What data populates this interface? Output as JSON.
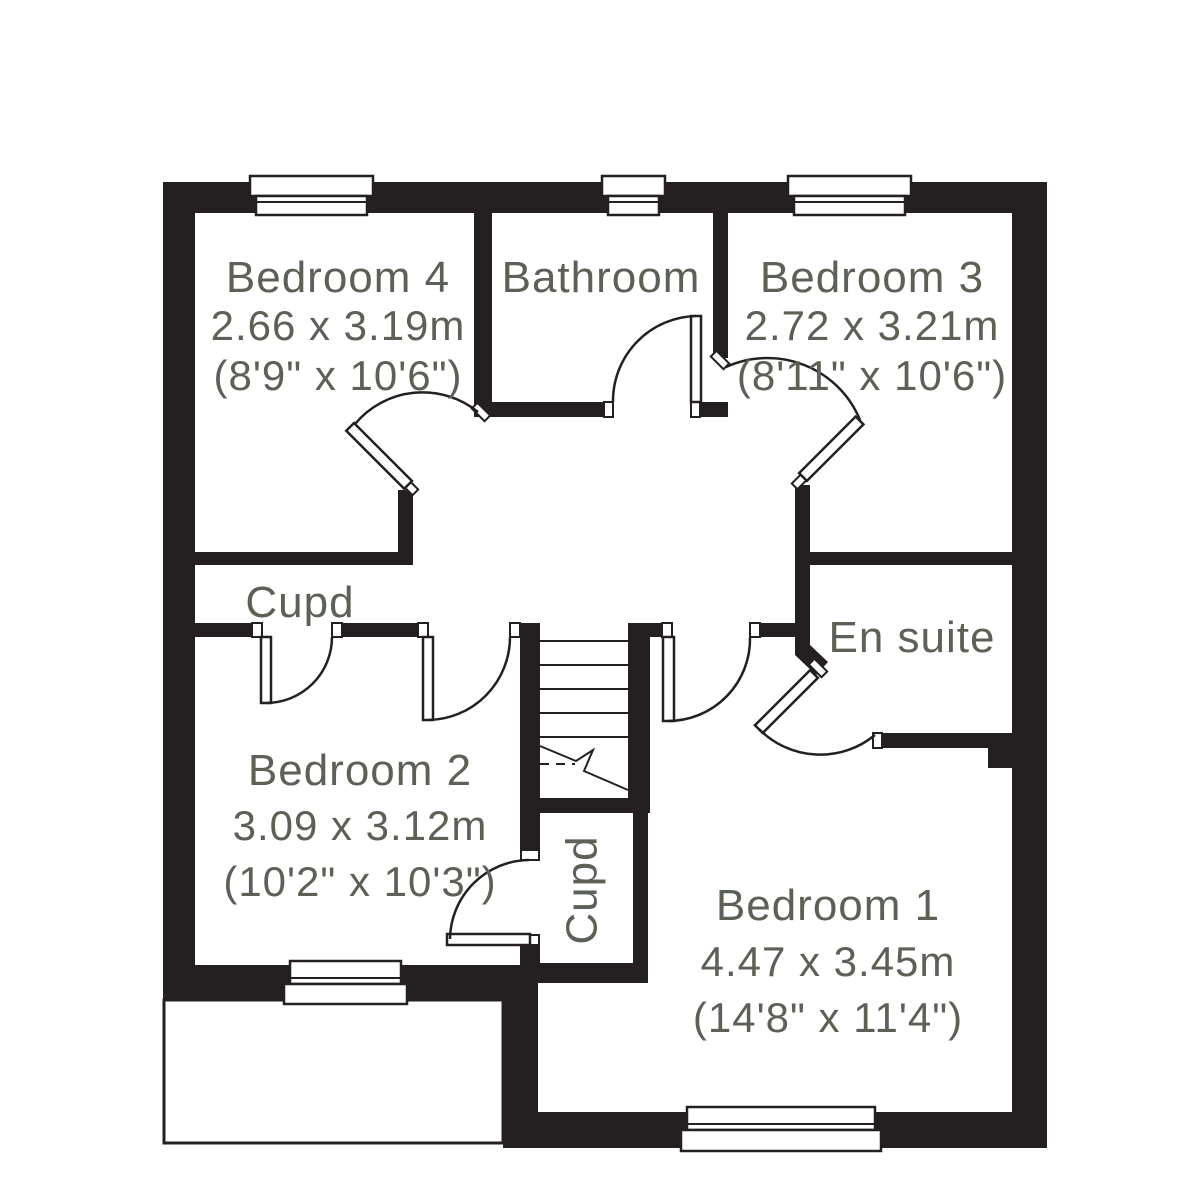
{
  "floorplan": {
    "background_color": "#ffffff",
    "wall_color": "#241f21",
    "label_color": "#5c6157",
    "rooms": [
      {
        "id": "bedroom-4",
        "label": "Bedroom 4",
        "size_metric": "2.66 x 3.19m",
        "size_imperial": "(8'9\" x 10'6\")"
      },
      {
        "id": "bathroom",
        "label": "Bathroom"
      },
      {
        "id": "bedroom-3",
        "label": "Bedroom 3",
        "size_metric": "2.72 x 3.21m",
        "size_imperial": "(8'11\" x 10'6\")"
      },
      {
        "id": "cupboard-landing",
        "label": "Cupd"
      },
      {
        "id": "en-suite",
        "label": "En suite"
      },
      {
        "id": "bedroom-2",
        "label": "Bedroom 2",
        "size_metric": "3.09 x 3.12m",
        "size_imperial": "(10'2\" x 10'3\")"
      },
      {
        "id": "cupboard-understairs",
        "label": "Cupd"
      },
      {
        "id": "bedroom-1",
        "label": "Bedroom 1",
        "size_metric": "4.47 x 3.45m",
        "size_imperial": "(14'8\" x 11'4\")"
      }
    ]
  }
}
